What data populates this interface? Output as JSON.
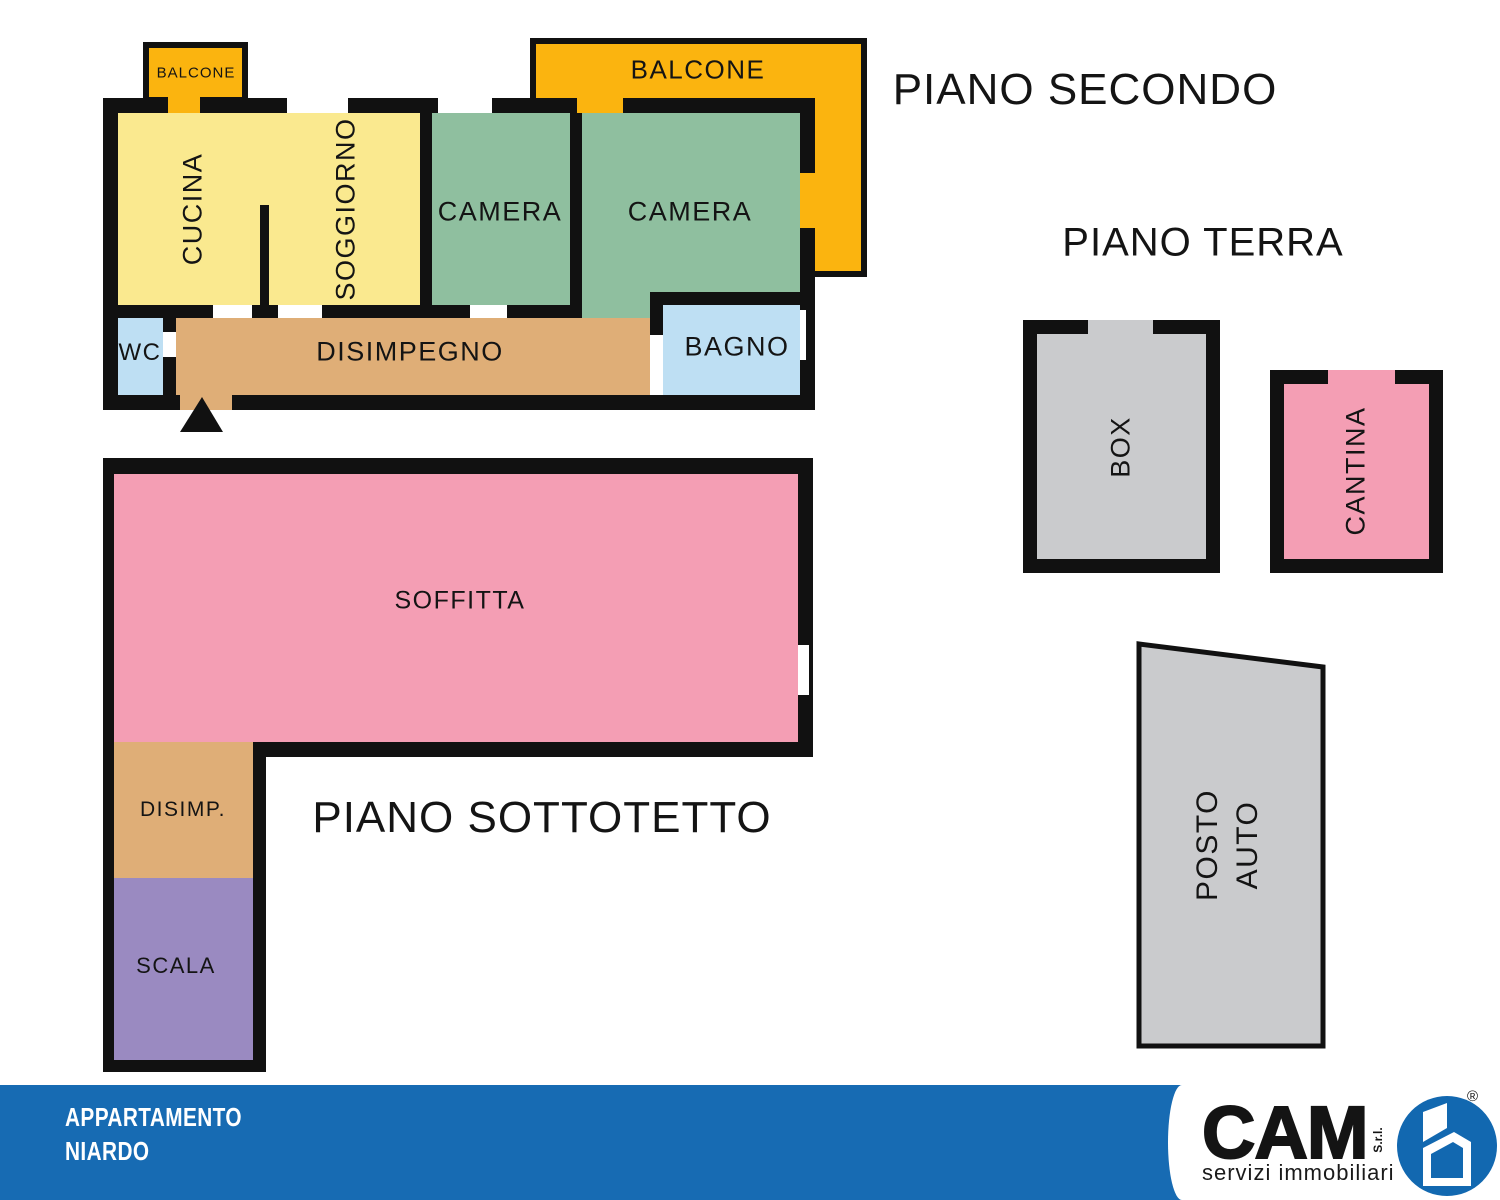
{
  "colors": {
    "wall": "#111111",
    "orange": "#FBB40F",
    "yellow": "#FAE98F",
    "green": "#8FBF9F",
    "lightblue": "#BEDFF3",
    "tan": "#DFAE77",
    "pink": "#F49EB4",
    "purple": "#9A8AC1",
    "gray": "#CACBCD",
    "footer_blue": "#176BB3",
    "logo_blue": "#1268B0"
  },
  "floors": {
    "secondo": {
      "title": "PIANO SECONDO",
      "rooms": {
        "balcone_small": "BALCONE",
        "balcone_large": "BALCONE",
        "cucina": "CUCINA",
        "soggiorno": "SOGGIORNO",
        "camera1": "CAMERA",
        "camera2": "CAMERA",
        "wc": "WC",
        "disimpegno": "DISIMPEGNO",
        "bagno": "BAGNO"
      }
    },
    "terra": {
      "title": "PIANO TERRA",
      "rooms": {
        "box": "BOX",
        "cantina": "CANTINA",
        "posto_auto_line1": "POSTO",
        "posto_auto_line2": "AUTO"
      }
    },
    "sottotetto": {
      "title": "PIANO SOTTOTETTO",
      "rooms": {
        "soffitta": "SOFFITTA",
        "disimp": "DISIMP.",
        "scala": "SCALA"
      }
    }
  },
  "footer": {
    "property_type": "APPARTAMENTO",
    "location": "NIARDO",
    "logo": {
      "name": "CAM",
      "suffix": "S.r.l.",
      "subtitle": "servizi immobiliari",
      "registered": "®"
    }
  }
}
